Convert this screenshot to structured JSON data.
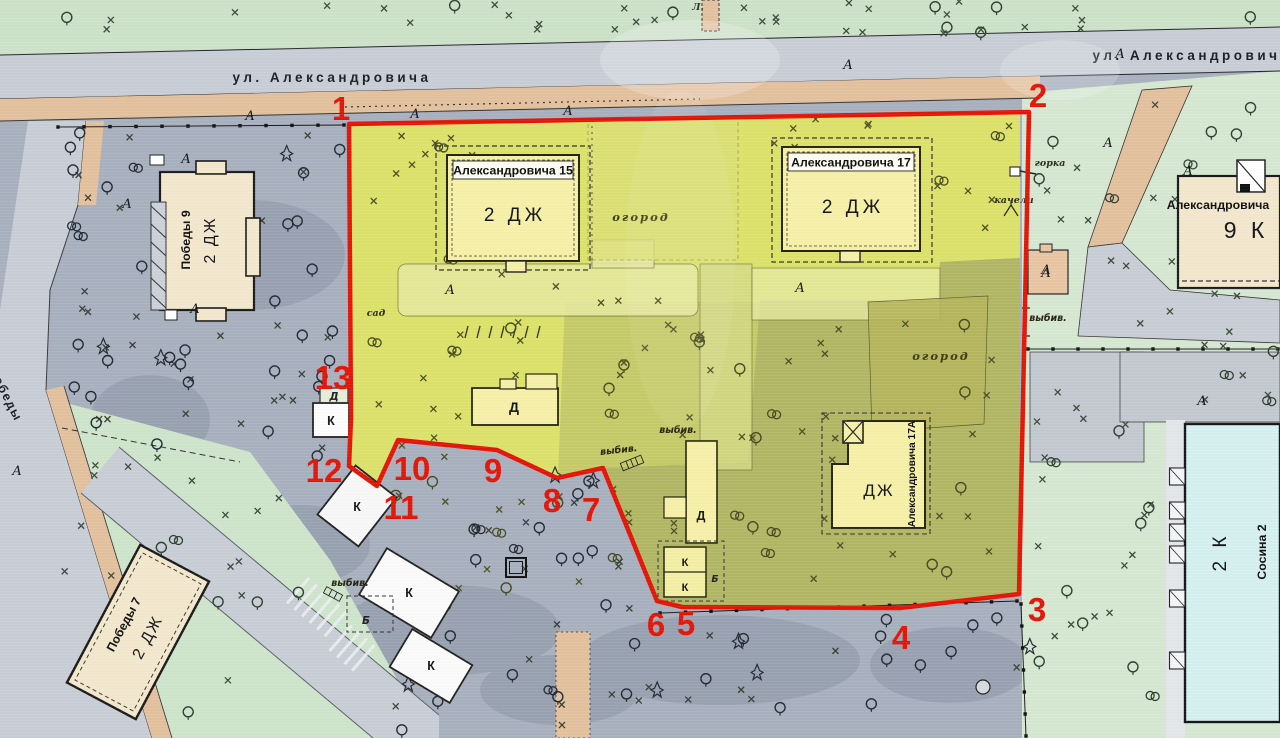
{
  "map": {
    "canvas": {
      "width": 1280,
      "height": 738
    },
    "palette": {
      "boundary_red": "#e41507",
      "highlight_yellow": "#dce26a",
      "highlight_olive": "#b2b765"
    },
    "streets": {
      "alexandrovicha": "ул. Александровича",
      "pobedy": "Победы",
      "top_partial_label": "Л."
    },
    "site_boundary": {
      "color": "#e41507",
      "points": "349,124 1029,112 1019,594 900,608 682,607 657,601 603,468 557,478 497,450 398,440 377,486 349,466 351,418",
      "vertices": [
        {
          "n": "1",
          "x": 341,
          "y": 109
        },
        {
          "n": "2",
          "x": 1038,
          "y": 96
        },
        {
          "n": "3",
          "x": 1037,
          "y": 610
        },
        {
          "n": "4",
          "x": 901,
          "y": 638
        },
        {
          "n": "5",
          "x": 686,
          "y": 624
        },
        {
          "n": "6",
          "x": 656,
          "y": 625
        },
        {
          "n": "7",
          "x": 591,
          "y": 510
        },
        {
          "n": "8",
          "x": 552,
          "y": 501
        },
        {
          "n": "9",
          "x": 493,
          "y": 471
        },
        {
          "n": "10",
          "x": 412,
          "y": 469
        },
        {
          "n": "11",
          "x": 401,
          "y": 508
        },
        {
          "n": "12",
          "x": 324,
          "y": 471
        },
        {
          "n": "13",
          "x": 333,
          "y": 378
        }
      ]
    },
    "buildings": {
      "aleks15": {
        "name": "Александровича 15",
        "type": "2 ДЖ"
      },
      "aleks17": {
        "name": "Александровича 17",
        "type": "2 ДЖ"
      },
      "aleks17a": {
        "name": "Александровича 17А",
        "type": "ДЖ"
      },
      "pobedy9": {
        "name": "Победы 9",
        "type": "2 ДЖ"
      },
      "pobedy7": {
        "name": "Победы 7",
        "type": "2 ДЖ"
      },
      "aleks9k": {
        "name": "Александровича",
        "type": "9 К"
      },
      "sosina2": {
        "name": "Сосина 2",
        "type": "2 К"
      }
    },
    "small_buildings": {
      "k": "К",
      "d": "Д",
      "b": "Б",
      "d_small": "Д"
    },
    "labels": {
      "ogorod": "огород",
      "sad": "сад",
      "gorka": "горка",
      "kacheli": "качели",
      "vybiv": "выбив.",
      "road_mark": "А"
    },
    "ogorod_positions": [
      {
        "x": 641,
        "y": 221
      },
      {
        "x": 941,
        "y": 360
      }
    ],
    "vybiv_positions": [
      {
        "x": 619,
        "y": 453,
        "r": -6
      },
      {
        "x": 678,
        "y": 433,
        "r": 0
      },
      {
        "x": 1048,
        "y": 321,
        "r": 0
      },
      {
        "x": 350,
        "y": 586,
        "r": 0
      }
    ],
    "road_mark_positions": [
      {
        "x": 250,
        "y": 120
      },
      {
        "x": 415,
        "y": 118
      },
      {
        "x": 568,
        "y": 115
      },
      {
        "x": 848,
        "y": 69
      },
      {
        "x": 1120,
        "y": 58
      },
      {
        "x": 186,
        "y": 163
      },
      {
        "x": 127,
        "y": 208
      },
      {
        "x": 195,
        "y": 313
      },
      {
        "x": 17,
        "y": 475
      },
      {
        "x": 450,
        "y": 294
      },
      {
        "x": 800,
        "y": 292
      },
      {
        "x": 1108,
        "y": 147
      },
      {
        "x": 1188,
        "y": 175
      },
      {
        "x": 1202,
        "y": 405
      },
      {
        "x": 1046,
        "y": 274
      }
    ]
  }
}
